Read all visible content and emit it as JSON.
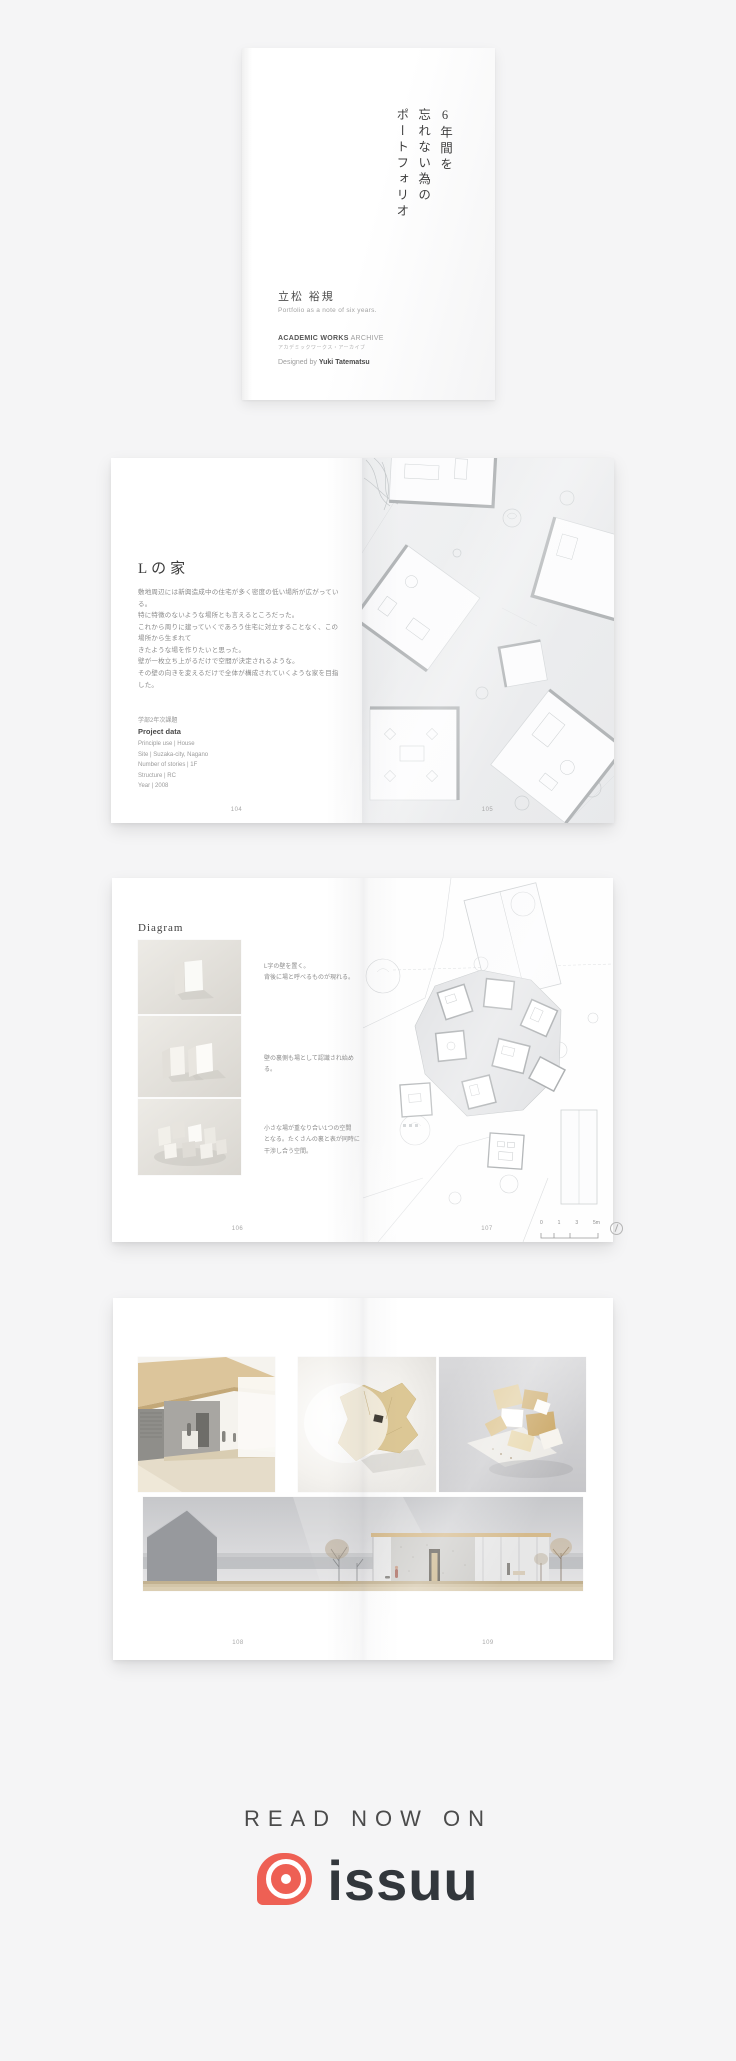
{
  "page": {
    "background": "#f5f5f6"
  },
  "cover": {
    "vertical_title_lines": [
      "6年間を",
      "忘れない為の",
      "ポートフォリオ"
    ],
    "author_name": "立松 裕規",
    "author_subtitle": "Portfolio as a note of six years.",
    "series_title_bold": "ACADEMIC WORKS",
    "series_title_light": "ARCHIVE",
    "series_title_jp": "アカデミックワークス・アーカイブ",
    "designed_by_label": "Designed by ",
    "designer_name": "Yuki Tatematsu"
  },
  "spread_house": {
    "title": "Lの家",
    "body_lines": [
      "敷地周辺には新興造成中の住宅が多く密度の低い場所が広がっている。",
      "特に特徴のないような場所とも言えるところだった。",
      "これから周りに建っていくであろう住宅に対立することなく、この場所から生まれて",
      "きたような場を作りたいと思った。",
      "壁が一枚立ち上がるだけで空間が決定されるような。",
      "その壁の向きを変えるだけで全体が構成されていくような家を目指した。"
    ],
    "assignment_label": "学部2年次課題",
    "project_data_title": "Project data",
    "project_data_lines": [
      "Principle use | House",
      "Site | Suzaka-city, Nagano",
      "Number of stories | 1F",
      "Structure | RC",
      "Year | 2008"
    ],
    "page_number_left": "104",
    "page_number_right": "105"
  },
  "spread_diagram": {
    "title": "Diagram",
    "caption1_lines": [
      "L字の壁を置く。",
      "背後に場と呼べるものが現れる。"
    ],
    "caption2_lines": [
      "壁の裏側も場として認識され始める。"
    ],
    "caption3_lines": [
      "小さな場が重なり合い1つの空間",
      "となる。たくさんの裏と表が同時に",
      "干渉し合う空間。"
    ],
    "scale_ticks": [
      "0",
      "1",
      "3",
      "5m"
    ],
    "page_number_left": "106",
    "page_number_right": "107"
  },
  "spread_renders": {
    "page_number_left": "108",
    "page_number_right": "109"
  },
  "branding": {
    "read_now_label": "READ NOW ON",
    "wordmark": "issuu",
    "brand_color": "#ee6054",
    "wordmark_color": "#32373c"
  }
}
